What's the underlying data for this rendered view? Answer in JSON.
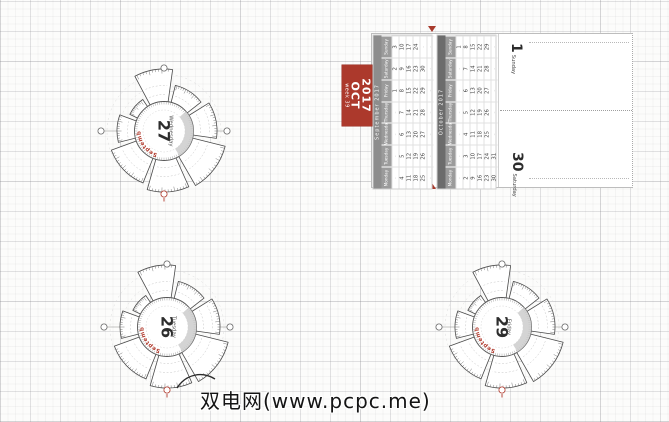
{
  "page": {
    "watermark": "双电网(www.pcpc.me)"
  },
  "colors": {
    "accent_red": "#ac392c",
    "september_bar": "#8d8d8d",
    "october_bar": "#6c6c6c",
    "day_header_gray": "#9b9b9b"
  },
  "week_badge": {
    "week_label": "week 39",
    "month": "OCT",
    "year": "2017"
  },
  "months": [
    {
      "title": "September 2017",
      "bar_color": "#8d8d8d",
      "day_names": [
        "Monday",
        "Tuesday",
        "Wednesday",
        "Thursday",
        "Friday",
        "Saturday",
        "Sunday"
      ],
      "weeks": [
        [
          "",
          "",
          "",
          "",
          "1",
          "2",
          "3"
        ],
        [
          "4",
          "5",
          "6",
          "7",
          "8",
          "9",
          "10"
        ],
        [
          "11",
          "12",
          "13",
          "14",
          "15",
          "16",
          "17"
        ],
        [
          "18",
          "19",
          "20",
          "21",
          "22",
          "23",
          "24"
        ],
        [
          "25",
          "26",
          "27",
          "28",
          "29",
          "30",
          ""
        ],
        [
          "",
          "",
          "",
          "",
          "",
          "",
          ""
        ]
      ]
    },
    {
      "title": "October 2017",
      "bar_color": "#6c6c6c",
      "day_names": [
        "Monday",
        "Tuesday",
        "Wednesday",
        "Thursday",
        "Friday",
        "Saturday",
        "Sunday"
      ],
      "weeks": [
        [
          "",
          "",
          "",
          "",
          "",
          "",
          "1"
        ],
        [
          "2",
          "3",
          "4",
          "5",
          "6",
          "7",
          "8"
        ],
        [
          "9",
          "10",
          "11",
          "12",
          "13",
          "14",
          "15"
        ],
        [
          "16",
          "17",
          "18",
          "19",
          "20",
          "21",
          "22"
        ],
        [
          "23",
          "24",
          "25",
          "26",
          "27",
          "28",
          "29"
        ],
        [
          "30",
          "31",
          "",
          "",
          "",
          "",
          ""
        ]
      ]
    }
  ],
  "day_pages": [
    {
      "number": "1",
      "day": "Sunday"
    },
    {
      "number": "30",
      "day": "Saturday"
    }
  ],
  "fans": [
    {
      "number": "27",
      "day": "Wednesday",
      "month_label": "September"
    },
    {
      "number": "26",
      "day": "Tuesday",
      "month_label": "September"
    },
    {
      "number": "29",
      "day": "Friday",
      "month_label": "September"
    }
  ]
}
